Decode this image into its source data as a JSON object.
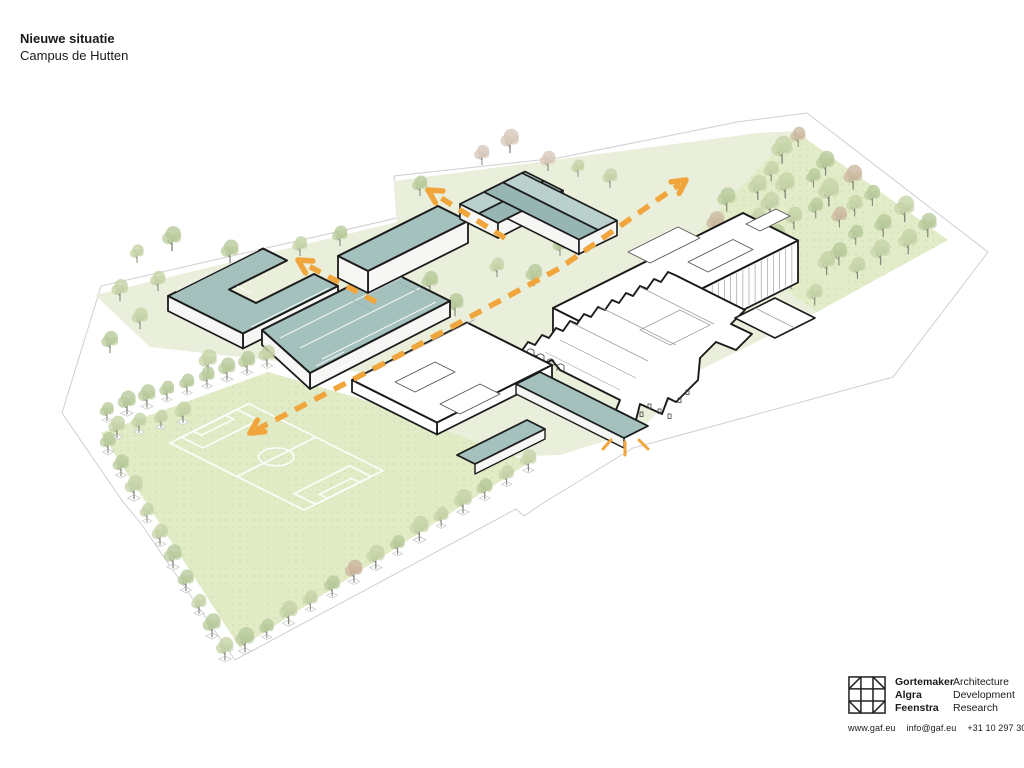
{
  "header": {
    "title": "Nieuwe situatie",
    "subtitle": "Campus de Hutten"
  },
  "plan": {
    "description": "Axonometric site plan with new teal-roofed school buildings, existing white monumental complex, sports field, tree rows, forest patch and orange dashed pedestrian routes",
    "route_count": 3,
    "entrance_marker": "sunburst"
  },
  "footer": {
    "names": [
      "Gortemaker",
      "Algra",
      "Feenstra"
    ],
    "services": [
      "Architecture",
      "Development",
      "Research"
    ],
    "contact": [
      "www.gaf.eu",
      "info@gaf.eu",
      "+31 10 297 3030"
    ]
  },
  "colors": {
    "accent_orange": "#f0a63c",
    "roof_teal": "#a4c1bd",
    "roof_teal_light": "#b9d0cc",
    "roof_teal_dark": "#97b5b2",
    "wall_white": "#f6f7f4",
    "campus_green": "#e9efda",
    "field_green": "#e1ebc6",
    "forest_green": "#e3ecc9",
    "tree_green": "#c5d3a7",
    "tree_green_dark": "#b8cb9b",
    "tree_pink": "#d8c8ba",
    "outline_black": "#1b1b1b",
    "outline_gray": "#cfcfcf",
    "detail_gray": "#999999",
    "pitch_line": "#ffffff"
  }
}
